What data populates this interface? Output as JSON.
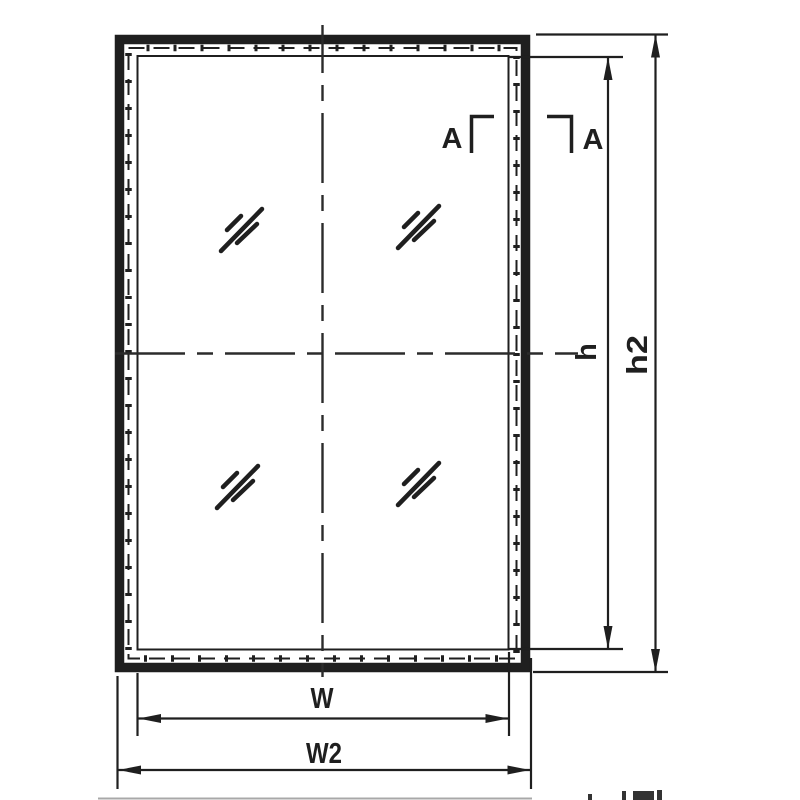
{
  "labels": {
    "section_left": "A",
    "section_right": "A",
    "height_inner": "h",
    "height_outer": "h2",
    "width_inner": "W",
    "width_outer": "W2"
  },
  "colors": {
    "line": "#1f1f1f",
    "centerline": "#2b2b2b",
    "faint": "#a8a8a8",
    "background": "#ffffff"
  },
  "icons": {
    "glass_mark": "glass-diagonal-slash-icon",
    "arrows": [
      "arrow-up-icon",
      "arrow-down-icon",
      "arrow-left-icon",
      "arrow-right-icon"
    ]
  }
}
